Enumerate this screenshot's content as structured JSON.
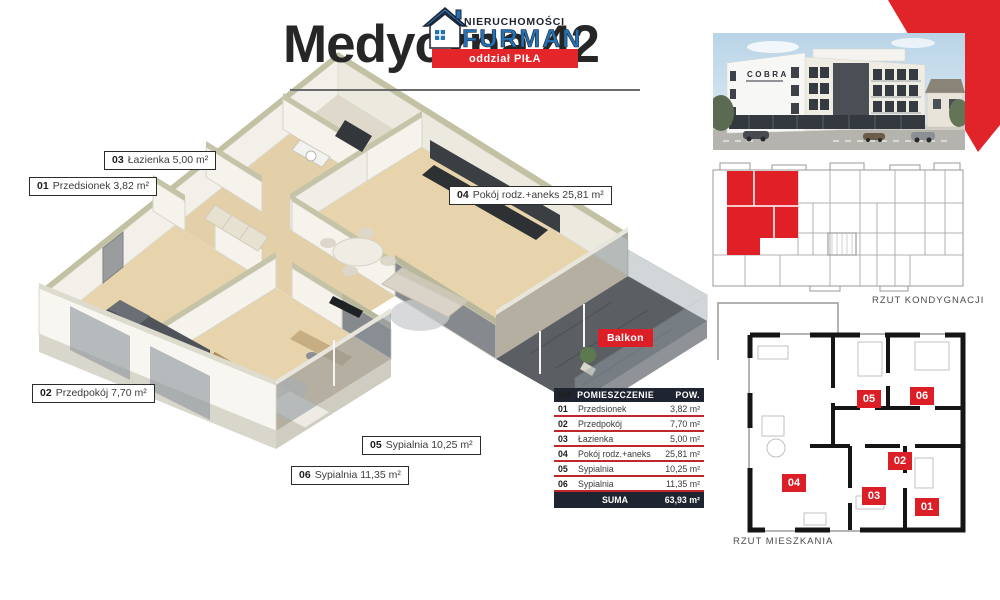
{
  "header": {
    "title": "Medyczna 42",
    "brand_top": "NIERUCHOMOŚCI",
    "brand_name": "FURMAN",
    "brand_band": "oddział PIŁA"
  },
  "labels": {
    "l03": {
      "num": "03",
      "text": "Łazienka 5,00 m²"
    },
    "l01": {
      "num": "01",
      "text": "Przedsionek 3,82 m²"
    },
    "l04": {
      "num": "04",
      "text": "Pokój rodz.+aneks 25,81 m²"
    },
    "l02": {
      "num": "02",
      "text": "Przedpokój 7,70 m²"
    },
    "l05": {
      "num": "05",
      "text": "Sypialnia 10,25 m²"
    },
    "l06": {
      "num": "06",
      "text": "Sypialnia 11,35 m²"
    },
    "balkon": "Balkon"
  },
  "table": {
    "col_nr": "NR",
    "col_room": "POMIESZCZENIE",
    "col_area": "POW.",
    "rows": [
      {
        "nr": "01",
        "room": "Przedsionek",
        "area": "3,82 m²"
      },
      {
        "nr": "02",
        "room": "Przedpokój",
        "area": "7,70 m²"
      },
      {
        "nr": "03",
        "room": "Łazienka",
        "area": "5,00 m²"
      },
      {
        "nr": "04",
        "room": "Pokój rodz.+aneks",
        "area": "25,81 m²"
      },
      {
        "nr": "05",
        "room": "Sypialnia",
        "area": "10,25 m²"
      },
      {
        "nr": "06",
        "room": "Sypialnia",
        "area": "11,35 m²"
      }
    ],
    "sum_label": "SUMA",
    "sum_value": "63,93 m²"
  },
  "side": {
    "building_sign": "COBRA",
    "caption_floor": "RZUT KONDYGNACJI",
    "caption_flat": "RZUT MIESZKANIA",
    "badges": [
      "01",
      "02",
      "03",
      "04",
      "05",
      "06"
    ]
  },
  "colors": {
    "accent_red": "#dc1f26",
    "brand_blue": "#2471b5",
    "dark_navy": "#1e2430",
    "wall_top_olive": "#c3c1a4",
    "floor_wood": "#e7d3ac"
  }
}
